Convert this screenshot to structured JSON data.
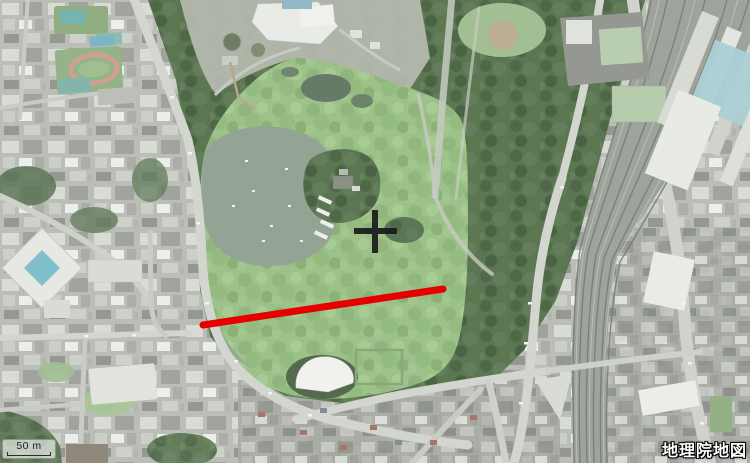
{
  "map": {
    "provider_label": "地理院地図",
    "scale_bar": {
      "label": "50 m"
    },
    "overlays": {
      "measure_line": {
        "color": "#e60000",
        "width": "7",
        "x1": "203",
        "y1": "325",
        "x2": "443",
        "y2": "289"
      },
      "center_marker": {
        "color": "#1a1a1a",
        "thickness": "6",
        "h_x1": "354",
        "h_y1": "231",
        "h_x2": "397",
        "h_y2": "231",
        "v_x1": "375",
        "v_y1": "210",
        "v_x2": "375",
        "v_y2": "253"
      }
    }
  }
}
